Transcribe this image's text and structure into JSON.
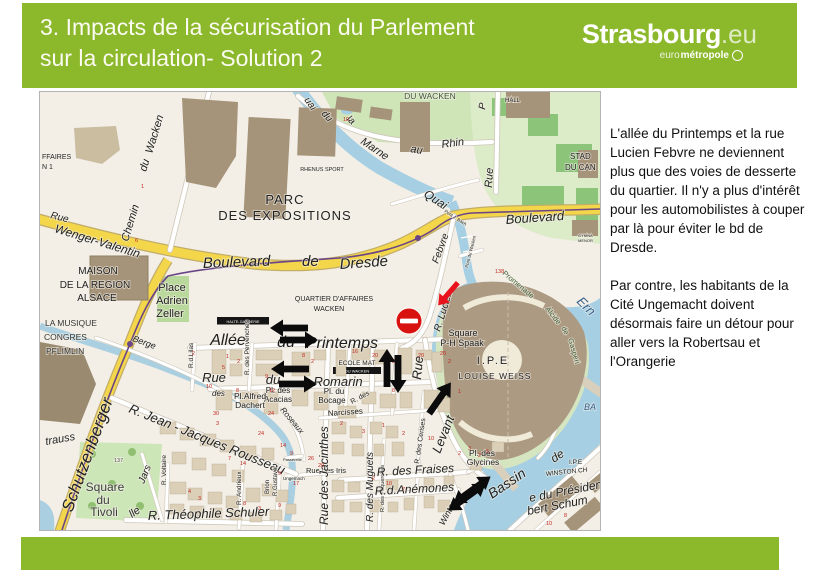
{
  "header": {
    "title_line1": "3. Impacts de la sécurisation du Parlement",
    "title_line2": "sur la circulation- Solution 2",
    "logo": {
      "main": "Strasbourg",
      "tld": ".eu",
      "sub_thin": "euro",
      "sub_bold": "métropole"
    }
  },
  "panel": {
    "para1": "L'allée du Printemps et la rue Lucien Febvre ne deviennent plus que des voies de desserte du quartier. Il n'y a plus d'intérêt pour les automobilistes à couper par là pour éviter le bd de Dresde.",
    "para2": "Par contre, les habitants de la Cité Ungemacht doivent désormais faire un détour pour aller vers la Robertsau et l'Orangerie"
  },
  "colors": {
    "accent_green": "#8cb82c",
    "map_bg": "#f3efe7",
    "water": "#a6cfe3",
    "road_yellow": "#f4d64b",
    "park": "#cfe5b8",
    "building": "#a6947a",
    "arrow_black": "#0b0b0b",
    "arrow_red": "#e8131c",
    "no_entry_red": "#d8130f"
  },
  "map": {
    "street_labels": [
      {
        "t": "FFAIRES",
        "x": 2,
        "y": 67,
        "s": 7
      },
      {
        "t": "N 1",
        "x": 2,
        "y": 77,
        "s": 7
      },
      {
        "t": "Rue",
        "x": 10,
        "y": 126,
        "r": 14,
        "s": 10,
        "i": 1
      },
      {
        "t": "Wenger-Valentin",
        "x": 14,
        "y": 140,
        "r": 17,
        "s": 12,
        "i": 1
      },
      {
        "t": "Chemin",
        "x": 88,
        "y": 150,
        "r": -73,
        "s": 11,
        "i": 1
      },
      {
        "t": "du",
        "x": 106,
        "y": 80,
        "r": -73,
        "s": 11,
        "i": 1
      },
      {
        "t": "Wacken",
        "x": 112,
        "y": 62,
        "r": -73,
        "s": 11,
        "i": 1
      },
      {
        "t": "PARC",
        "x": 245,
        "y": 112,
        "s": 13,
        "a": "middle",
        "ls": 1
      },
      {
        "t": "DES EXPOSITIONS",
        "x": 245,
        "y": 128,
        "s": 13,
        "a": "middle",
        "ls": 1
      },
      {
        "t": "RHENUS SPORT",
        "x": 282,
        "y": 79,
        "s": 5.5,
        "a": "middle"
      },
      {
        "t": "DU WACKEN",
        "x": 390,
        "y": 7,
        "s": 8.5,
        "a": "middle",
        "c": "#44543a"
      },
      {
        "t": "uai",
        "x": 264,
        "y": 8,
        "r": 55,
        "s": 10,
        "i": 1
      },
      {
        "t": "du",
        "x": 281,
        "y": 22,
        "r": 48,
        "s": 10,
        "i": 1
      },
      {
        "t": "la",
        "x": 306,
        "y": 28,
        "r": 40,
        "s": 10,
        "i": 1
      },
      {
        "t": "Marne",
        "x": 320,
        "y": 51,
        "r": 34,
        "s": 11,
        "i": 1
      },
      {
        "t": "au",
        "x": 370,
        "y": 60,
        "r": 10,
        "s": 11,
        "i": 1
      },
      {
        "t": "Rhin",
        "x": 402,
        "y": 56,
        "r": -8,
        "s": 11,
        "i": 1
      },
      {
        "t": "Quai",
        "x": 383,
        "y": 104,
        "r": 33,
        "s": 12,
        "i": 1
      },
      {
        "t": "Pont J. Bach",
        "x": 404,
        "y": 120,
        "r": 33,
        "s": 4.5
      },
      {
        "t": "HALL",
        "x": 465,
        "y": 10,
        "s": 6
      },
      {
        "t": "P",
        "x": 445,
        "y": 18,
        "r": -80,
        "s": 10,
        "i": 1
      },
      {
        "t": "Rue",
        "x": 452,
        "y": 96,
        "r": -87,
        "s": 11,
        "i": 1
      },
      {
        "t": "STAD",
        "x": 530,
        "y": 67,
        "s": 8
      },
      {
        "t": "DU CAN",
        "x": 525,
        "y": 78,
        "s": 8
      },
      {
        "t": "Boulevard",
        "x": 466,
        "y": 132,
        "r": -4,
        "s": 13,
        "i": 1
      },
      {
        "t": "GYMNA",
        "x": 538,
        "y": 145,
        "s": 4
      },
      {
        "t": "MENOR",
        "x": 538,
        "y": 150,
        "s": 4
      },
      {
        "t": "Pont du Wacken",
        "x": 428,
        "y": 176,
        "r": -76,
        "s": 4.5
      },
      {
        "t": "Boulevard",
        "x": 163,
        "y": 176,
        "r": -2,
        "s": 15,
        "i": 1
      },
      {
        "t": "de",
        "x": 262,
        "y": 174,
        "s": 15,
        "i": 1
      },
      {
        "t": "Dresde",
        "x": 300,
        "y": 177,
        "r": -4,
        "s": 15,
        "i": 1
      },
      {
        "t": "MAISON",
        "x": 58,
        "y": 182,
        "s": 10,
        "a": "middle"
      },
      {
        "t": "DE LA REGION",
        "x": 55,
        "y": 196,
        "s": 10,
        "a": "middle"
      },
      {
        "t": "ALSACE",
        "x": 57,
        "y": 209,
        "s": 10,
        "a": "middle"
      },
      {
        "t": "Place",
        "x": 132,
        "y": 199,
        "s": 11,
        "a": "middle"
      },
      {
        "t": "Adrien",
        "x": 132,
        "y": 212,
        "s": 11,
        "a": "middle"
      },
      {
        "t": "Zeller",
        "x": 130,
        "y": 225,
        "s": 11,
        "a": "middle"
      },
      {
        "t": "LA MUSIQUE",
        "x": 5,
        "y": 234,
        "s": 8.5,
        "c": "#333333"
      },
      {
        "t": "CONGRES",
        "x": 4,
        "y": 248,
        "s": 8.5,
        "c": "#333333"
      },
      {
        "t": "PFLIMLIN",
        "x": 6,
        "y": 262,
        "s": 8.5,
        "c": "#333333"
      },
      {
        "t": "QUARTIER D'AFFAIRES",
        "x": 294,
        "y": 209,
        "s": 7,
        "a": "middle"
      },
      {
        "t": "WACKEN",
        "x": 289,
        "y": 219,
        "s": 7,
        "a": "middle"
      },
      {
        "t": "Ern",
        "x": 536,
        "y": 210,
        "r": 45,
        "s": 13,
        "i": 1,
        "c": "#355d8a"
      },
      {
        "t": "Allée",
        "x": 188,
        "y": 253,
        "s": 16,
        "i": 1,
        "a": "middle",
        "c": "#1c1c1c"
      },
      {
        "t": "du",
        "x": 246,
        "y": 255,
        "s": 16,
        "i": 1,
        "a": "middle",
        "c": "#1c1c1c"
      },
      {
        "t": "Printemps",
        "x": 302,
        "y": 256,
        "s": 16,
        "i": 1,
        "a": "middle",
        "c": "#1c1c1c"
      },
      {
        "t": "R. Lucien",
        "x": 400,
        "y": 240,
        "r": -73,
        "s": 10,
        "i": 1
      },
      {
        "t": "Febvre",
        "x": 398,
        "y": 172,
        "r": -70,
        "s": 10,
        "i": 1
      },
      {
        "t": "Square",
        "x": 423,
        "y": 244,
        "s": 9,
        "a": "middle"
      },
      {
        "t": "P-H Spaak",
        "x": 422,
        "y": 254,
        "s": 9,
        "a": "middle"
      },
      {
        "t": "Promenade",
        "x": 462,
        "y": 182,
        "r": 40,
        "s": 7.5,
        "c": "#3f5d33"
      },
      {
        "t": "Alcide",
        "x": 505,
        "y": 217,
        "r": 52,
        "s": 7.5,
        "c": "#3f5d33"
      },
      {
        "t": "de",
        "x": 521,
        "y": 236,
        "r": 62,
        "s": 7.5,
        "c": "#3f5d33"
      },
      {
        "t": "Gasperi",
        "x": 528,
        "y": 247,
        "r": 74,
        "s": 7.5,
        "c": "#3f5d33"
      },
      {
        "t": "I.P.E",
        "x": 453,
        "y": 272,
        "s": 11,
        "a": "middle",
        "ls": 2
      },
      {
        "t": "LOUISE WEISS",
        "x": 455,
        "y": 287,
        "s": 8.5,
        "a": "middle",
        "ls": 1
      },
      {
        "t": "HALTE-GARDERIE",
        "x": 203,
        "y": 231,
        "s": 3.8,
        "a": "middle",
        "c": "#fff"
      },
      {
        "t": "ECOLE MAT",
        "x": 317,
        "y": 273,
        "s": 6.5,
        "a": "middle"
      },
      {
        "t": "DU WACKEN",
        "x": 317,
        "y": 280.5,
        "s": 4,
        "a": "middle",
        "c": "#fff"
      },
      {
        "t": "R.d.Lilas",
        "x": 153,
        "y": 276,
        "r": -90,
        "s": 6.5
      },
      {
        "t": "R. des Pervenches",
        "x": 209,
        "y": 283,
        "r": -90,
        "s": 6.5
      },
      {
        "t": "Rue",
        "x": 174,
        "y": 290,
        "s": 13,
        "i": 1,
        "a": "middle"
      },
      {
        "t": "du",
        "x": 233,
        "y": 292,
        "s": 13,
        "i": 1,
        "a": "middle"
      },
      {
        "t": "Romarin",
        "x": 298,
        "y": 294,
        "s": 13,
        "i": 1,
        "a": "middle"
      },
      {
        "t": "Pl. des",
        "x": 238,
        "y": 301,
        "s": 8,
        "a": "middle"
      },
      {
        "t": "Acacias",
        "x": 238,
        "y": 310,
        "s": 8,
        "a": "middle"
      },
      {
        "t": "Pl. du",
        "x": 294,
        "y": 302,
        "s": 8,
        "a": "middle"
      },
      {
        "t": "Bocage",
        "x": 292,
        "y": 311,
        "s": 8,
        "a": "middle"
      },
      {
        "t": "R. des",
        "x": 312,
        "y": 312,
        "r": -28,
        "s": 7
      },
      {
        "t": "Narcisses",
        "x": 288,
        "y": 324,
        "r": -4,
        "s": 8
      },
      {
        "t": "Pl.Alfred",
        "x": 210,
        "y": 307,
        "s": 8.5,
        "a": "middle"
      },
      {
        "t": "Dachert",
        "x": 210,
        "y": 316,
        "s": 8.5,
        "a": "middle"
      },
      {
        "t": "des",
        "x": 172,
        "y": 304,
        "s": 8,
        "i": 1
      },
      {
        "t": "Berge",
        "x": 92,
        "y": 249,
        "r": 20,
        "s": 9,
        "i": 1
      },
      {
        "t": "Roseaux",
        "x": 240,
        "y": 318,
        "r": 50,
        "s": 8,
        "i": 1
      },
      {
        "t": "R. Jean - Jacques Rousseau",
        "x": 88,
        "y": 320,
        "r": 22,
        "s": 13,
        "i": 1
      },
      {
        "t": "trauss",
        "x": 6,
        "y": 353,
        "r": -10,
        "s": 11,
        "i": 1
      },
      {
        "t": "Schutzenberger",
        "x": 32,
        "y": 421,
        "r": -70,
        "s": 17,
        "i": 1
      },
      {
        "t": "Square",
        "x": 65,
        "y": 399,
        "s": 12,
        "a": "middle",
        "c": "#3d3d3d"
      },
      {
        "t": "du",
        "x": 63,
        "y": 412,
        "s": 12,
        "a": "middle",
        "c": "#3d3d3d"
      },
      {
        "t": "Tivoli",
        "x": 64,
        "y": 424,
        "s": 12,
        "a": "middle",
        "c": "#3d3d3d"
      },
      {
        "t": "Jars",
        "x": 104,
        "y": 392,
        "r": -68,
        "s": 10,
        "i": 1
      },
      {
        "t": "R. Voltaire",
        "x": 126,
        "y": 393,
        "r": -90,
        "s": 6.5
      },
      {
        "t": "R. Andrieux",
        "x": 201,
        "y": 413,
        "r": -90,
        "s": 6.5
      },
      {
        "t": "R.Gustave",
        "x": 237,
        "y": 404,
        "r": -90,
        "s": 6
      },
      {
        "t": "Brion",
        "x": 229,
        "y": 402,
        "r": -90,
        "s": 6
      },
      {
        "t": "lle",
        "x": 92,
        "y": 426,
        "r": -35,
        "s": 11,
        "i": 1
      },
      {
        "t": "R. Théophile Schuler",
        "x": 108,
        "y": 428,
        "r": -2,
        "s": 13,
        "i": 1
      },
      {
        "t": "Passerelle",
        "x": 243,
        "y": 369,
        "s": 4
      },
      {
        "t": "Ungemach",
        "x": 243,
        "y": 388,
        "s": 4.5
      },
      {
        "t": "Rue des Iris",
        "x": 266,
        "y": 381,
        "s": 7.5
      },
      {
        "t": "Rue des Jacinthes",
        "x": 288,
        "y": 433,
        "r": -90,
        "s": 12,
        "i": 1
      },
      {
        "t": "R. des Muguets",
        "x": 333,
        "y": 430,
        "r": -90,
        "s": 10,
        "i": 1
      },
      {
        "t": "R. des Pâquerettes",
        "x": 344,
        "y": 420,
        "r": -90,
        "s": 5.5
      },
      {
        "t": "R. des Cerises",
        "x": 379,
        "y": 372,
        "r": -82,
        "s": 7
      },
      {
        "t": "R. des Fraises",
        "x": 337,
        "y": 384,
        "r": -3,
        "s": 12,
        "i": 1
      },
      {
        "t": "R.d.Anémones",
        "x": 335,
        "y": 403,
        "r": -3,
        "s": 12,
        "i": 1
      },
      {
        "t": "Pl. des",
        "x": 442,
        "y": 364,
        "s": 8.5,
        "a": "middle"
      },
      {
        "t": "Glycines",
        "x": 443,
        "y": 373,
        "s": 8.5,
        "a": "middle"
      },
      {
        "t": "Rue",
        "x": 381,
        "y": 288,
        "r": -85,
        "s": 13,
        "i": 1
      },
      {
        "t": "Levant",
        "x": 400,
        "y": 362,
        "r": -68,
        "s": 13,
        "i": 1
      },
      {
        "t": "Winter",
        "x": 404,
        "y": 434,
        "r": -62,
        "s": 9,
        "i": 1
      },
      {
        "t": "Bassin",
        "x": 452,
        "y": 407,
        "r": -34,
        "s": 14,
        "i": 1
      },
      {
        "t": "de",
        "x": 514,
        "y": 371,
        "r": -34,
        "s": 12,
        "i": 1
      },
      {
        "t": "WINSTON CH",
        "x": 506,
        "y": 384,
        "r": -6,
        "s": 6.5
      },
      {
        "t": "I.P.E",
        "x": 529,
        "y": 372,
        "s": 6.5
      },
      {
        "t": "e du Président",
        "x": 490,
        "y": 410,
        "r": -11,
        "s": 12,
        "i": 1
      },
      {
        "t": "bert Schum",
        "x": 488,
        "y": 423,
        "r": -11,
        "s": 12,
        "i": 1
      },
      {
        "t": "BA",
        "x": 544,
        "y": 318,
        "s": 9,
        "i": 1,
        "c": "#355d8a"
      },
      {
        "t": "137",
        "x": 74,
        "y": 370,
        "s": 5.5,
        "c": "#555"
      }
    ],
    "house_numbers": [
      [
        "1",
        101,
        96
      ],
      [
        "6",
        95,
        150
      ],
      [
        "10",
        303,
        29
      ],
      [
        "138",
        455,
        181
      ],
      [
        "1",
        186,
        266
      ],
      [
        "2",
        197,
        271
      ],
      [
        "5",
        182,
        277
      ],
      [
        "2",
        152,
        263
      ],
      [
        "10",
        166,
        296
      ],
      [
        "8",
        196,
        300
      ],
      [
        "9",
        225,
        286
      ],
      [
        "12",
        229,
        300
      ],
      [
        "8",
        262,
        265
      ],
      [
        "2",
        271,
        271
      ],
      [
        "16",
        312,
        261
      ],
      [
        "20",
        332,
        265
      ],
      [
        "2",
        352,
        271
      ],
      [
        "20",
        378,
        265
      ],
      [
        "8",
        352,
        300
      ],
      [
        "2",
        300,
        333
      ],
      [
        "3",
        322,
        341
      ],
      [
        "1",
        342,
        335
      ],
      [
        "2",
        362,
        343
      ],
      [
        "10",
        388,
        348
      ],
      [
        "2",
        332,
        388
      ],
      [
        "10",
        346,
        393
      ],
      [
        "7",
        362,
        399
      ],
      [
        "24",
        228,
        323
      ],
      [
        "24",
        218,
        343
      ],
      [
        "30",
        173,
        323
      ],
      [
        "3",
        176,
        333
      ],
      [
        "14",
        240,
        355
      ],
      [
        "9",
        250,
        363
      ],
      [
        "26",
        268,
        368
      ],
      [
        "20",
        278,
        375
      ],
      [
        "9",
        238,
        383
      ],
      [
        "17",
        253,
        393
      ],
      [
        "8",
        203,
        413
      ],
      [
        "3",
        218,
        418
      ],
      [
        "9",
        238,
        415
      ],
      [
        "7",
        188,
        368
      ],
      [
        "14",
        200,
        373
      ],
      [
        "4",
        148,
        401
      ],
      [
        "3",
        158,
        408
      ],
      [
        "3",
        428,
        358
      ],
      [
        "2",
        418,
        363
      ],
      [
        "2",
        438,
        365
      ],
      [
        "5",
        446,
        361
      ],
      [
        "10",
        506,
        433
      ],
      [
        "8",
        524,
        425
      ],
      [
        "1",
        418,
        301
      ],
      [
        "20",
        400,
        263
      ],
      [
        "2",
        408,
        271
      ]
    ],
    "arrows": [
      {
        "d": "left",
        "x": 249,
        "y": 236
      },
      {
        "d": "right",
        "x": 259,
        "y": 248
      },
      {
        "d": "left",
        "x": 250,
        "y": 277
      },
      {
        "d": "right",
        "x": 258,
        "y": 292
      },
      {
        "d": "up",
        "x": 347,
        "y": 276
      },
      {
        "d": "down",
        "x": 358,
        "y": 282
      },
      {
        "d": "ne",
        "x": 400,
        "y": 306
      },
      {
        "d": "double",
        "x": 432,
        "y": 398,
        "r": -36
      },
      {
        "d": "double",
        "x": 427,
        "y": 405,
        "r": -36
      },
      {
        "d": "sw",
        "x": 408,
        "y": 202,
        "c": "#e8131c"
      }
    ],
    "no_entry_sign": {
      "x": 369,
      "y": 229,
      "r": 13
    }
  }
}
